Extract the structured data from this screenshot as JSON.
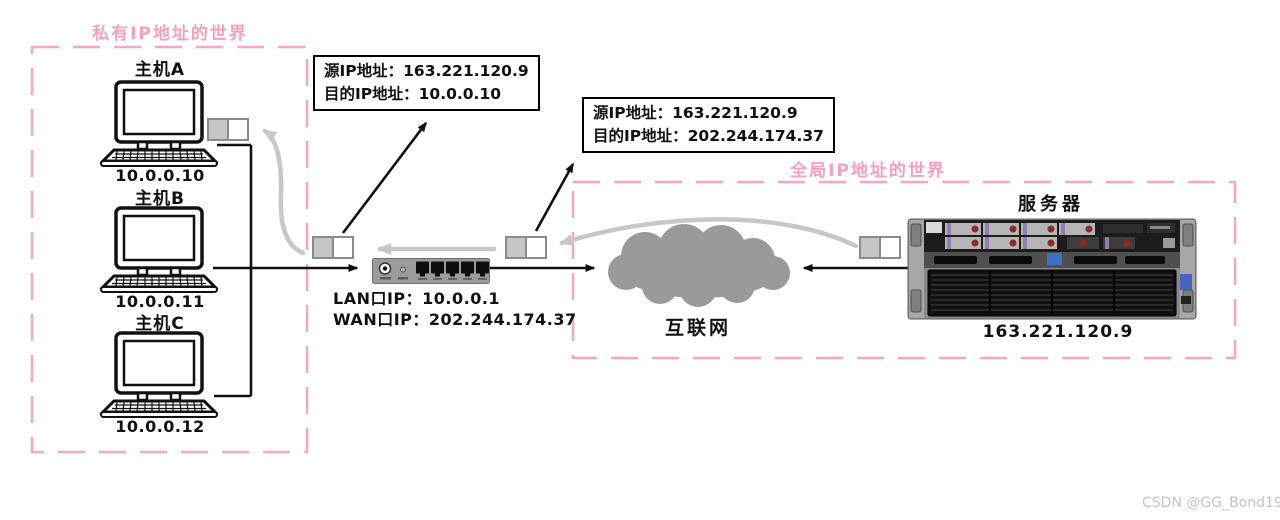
{
  "diagram": {
    "private_zone": {
      "title": "私有IP地址的世界",
      "hosts": [
        {
          "name": "主机A",
          "ip": "10.0.0.10"
        },
        {
          "name": "主机B",
          "ip": "10.0.0.11"
        },
        {
          "name": "主机C",
          "ip": "10.0.0.12"
        }
      ]
    },
    "global_zone": {
      "title": "全局IP地址的世界"
    },
    "packet_labels": [
      {
        "line1": "源IP地址：163.221.120.9",
        "line2": "目的IP地址：10.0.0.10"
      },
      {
        "line1": "源IP地址：163.221.120.9",
        "line2": "目的IP地址：202.244.174.37"
      }
    ],
    "router": {
      "lan": "LAN口IP：10.0.0.1",
      "wan": "WAN口IP：202.244.174.37"
    },
    "internet": {
      "label": "互联网"
    },
    "server": {
      "title": "服务器",
      "ip": "163.221.120.9"
    }
  },
  "watermark": "CSDN @GG_Bond19",
  "colors": {
    "zone_pink": "#f79fbe",
    "return_arrow_gray": "#c7c7c7",
    "cloud_gray": "#9a9a9a",
    "packet_fill_gray": "#c6c6c6"
  }
}
